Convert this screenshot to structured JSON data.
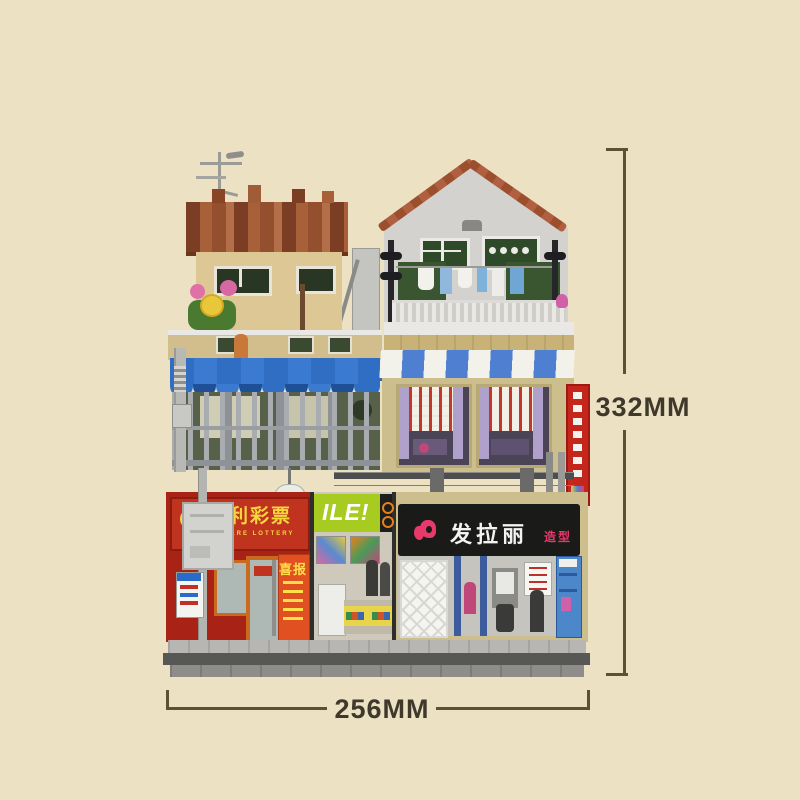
{
  "scene": {
    "background": "#EDE1C3"
  },
  "dimensions": {
    "height_label": "332MM",
    "width_label": "256MM",
    "line_color": "#5B5233",
    "text_color": "#3F392B"
  },
  "signs": {
    "lottery_cn": "福利彩票",
    "lottery_en": "WELFARE LOTTERY",
    "smile": "ILE!",
    "salon_name": "发拉丽",
    "salon_suffix": "造型",
    "poster": "喜报"
  },
  "colors": {
    "background": "#EDE1C3",
    "left_roof_brown": "#94502E",
    "left_wall_tan": "#DCC795",
    "right_house_gray": "#D3D2CE",
    "right_roof_brown": "#9C4F2D",
    "awning_blue": "#2F6EC2",
    "stripe_awning_blue": "#4E7FD0",
    "balcony_green": "#57614A",
    "right_wall_tan": "#CDBE8D",
    "curtain_purple": "#AFA0CC",
    "vertical_sign_red": "#C5261C",
    "lottery_red": "#A82315",
    "lottery_sign_red": "#C0331F",
    "lottery_text_yellow": "#F5D73B",
    "smile_lime": "#A8CB21",
    "salon_sign_black": "#1A1A18",
    "salon_pink": "#E8396B",
    "cabinet_blue": "#4B87C9",
    "base_gray_light": "#B7B6B2",
    "base_gray_dark": "#575755"
  }
}
